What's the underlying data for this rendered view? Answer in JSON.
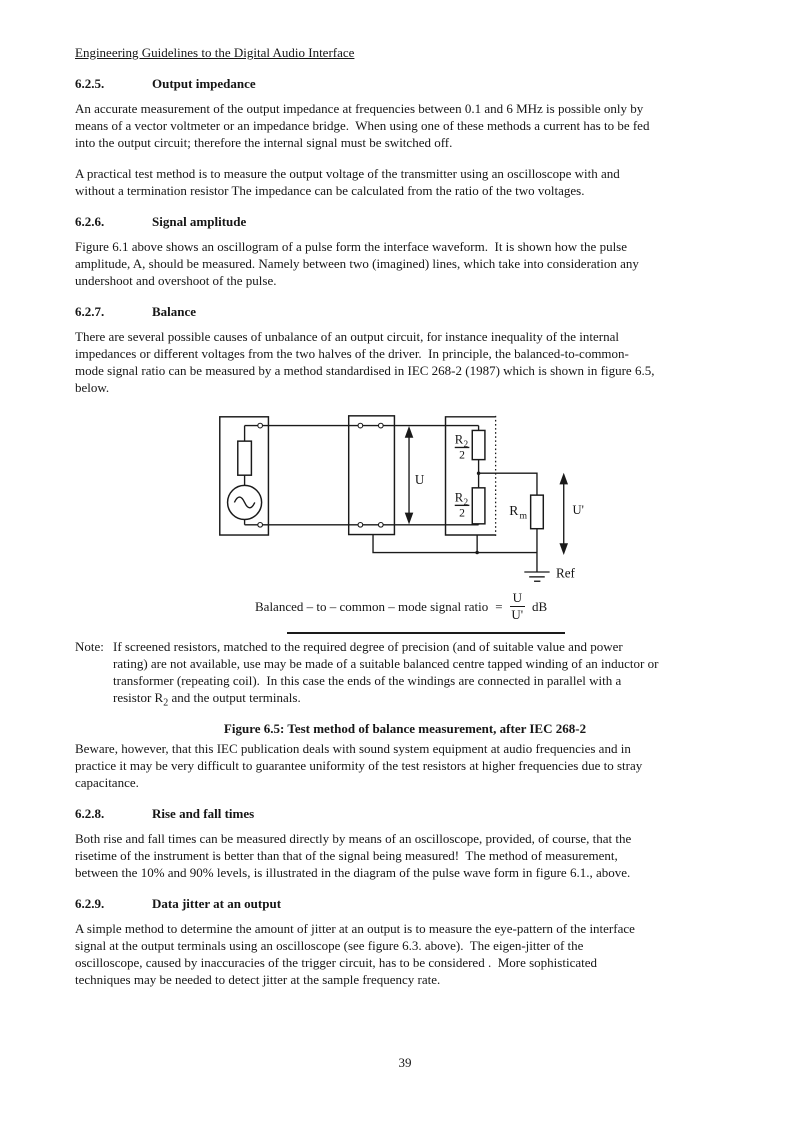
{
  "header": {
    "title": "Engineering Guidelines to the Digital Audio Interface"
  },
  "sections": [
    {
      "num": "6.2.5.",
      "title": "Output impedance",
      "paragraphs": [
        "An accurate measurement of the output impedance at frequencies between 0.1 and 6 MHz is possible only by\nmeans of a vector voltmeter or an impedance bridge.  When using one of these methods a current has to be fed\ninto the output circuit; therefore the internal signal must be switched off.",
        "A practical test method is to measure the output voltage of the transmitter using an oscilloscope with and\nwithout a termination resistor The impedance can be calculated from the ratio of the two voltages."
      ]
    },
    {
      "num": "6.2.6.",
      "title": "Signal amplitude",
      "paragraphs": [
        "Figure 6.1 above shows an oscillogram of a pulse form the interface waveform.  It is shown how the pulse\namplitude, A, should be measured. Namely between two (imagined) lines, which take into consideration any\nundershoot and overshoot of the pulse."
      ]
    },
    {
      "num": "6.2.7.",
      "title": "Balance",
      "paragraphs": [
        "There are several possible causes of unbalance of an output circuit, for instance inequality of the internal\nimpedances or different voltages from the two halves of the driver.  In principle, the balanced-to-common-\nmode signal ratio can be measured by a method standardised in IEC 268-2 (1987) which is shown in figure 6.5,\nbelow."
      ]
    },
    {
      "num": "6.2.8.",
      "title": "Rise and fall times",
      "paragraphs": [
        "Both rise and fall times can be measured directly by means of an oscilloscope, provided, of course, that the\nrisetime of the instrument is better than that of the signal being measured!  The method of measurement,\nbetween the 10% and 90% levels, is illustrated in the diagram of the pulse wave form in figure 6.1., above."
      ]
    },
    {
      "num": "6.2.9.",
      "title": "Data jitter at an output",
      "paragraphs": [
        "A simple method to determine the amount of jitter at an output is to measure the eye-pattern of the interface\nsignal at the output terminals using an oscilloscope (see figure 6.3. above).  The eigen-jitter of the\noscilloscope, caused by inaccuracies of the trigger circuit, has to be considered .  More sophisticated\ntechniques may be needed to detect jitter at the sample frequency rate."
      ]
    }
  ],
  "figure": {
    "caption": "Figure 6.5: Test method of balance measurement, after IEC 268-2",
    "note_label": "Note:",
    "note_text_1": "If screened resistors, matched to the required degree of precision (and of suitable value and power\nrating) are not available, use may be made of a suitable balanced centre tapped winding of an inductor or\ntransformer (repeating coil).  In this case the ends of the windings are connected in parallel with a\nresistor R",
    "note_sub": "2",
    "note_text_2": " and the output terminals.",
    "formula": {
      "lhs": "Balanced – to – common – mode signal ratio",
      "eq": "=",
      "num": "U",
      "den": "U'",
      "unit": "dB"
    },
    "diagram": {
      "u_label": "U",
      "u_prime_label": "U'",
      "ref_label": "Ref",
      "r_top_base": "R",
      "r_top_sub": "2",
      "r_top_den": "2",
      "r_bot_base": "R",
      "r_bot_sub": "2",
      "r_bot_den": "2",
      "rm_base": "R",
      "rm_sub": "m"
    }
  },
  "after_figure_paragraph": "Beware, however, that this IEC publication deals with sound system equipment at audio frequencies and in\npractice it may be very difficult to guarantee uniformity of the test resistors at higher frequencies due to stray\ncapacitance.",
  "page": {
    "number": "39"
  }
}
